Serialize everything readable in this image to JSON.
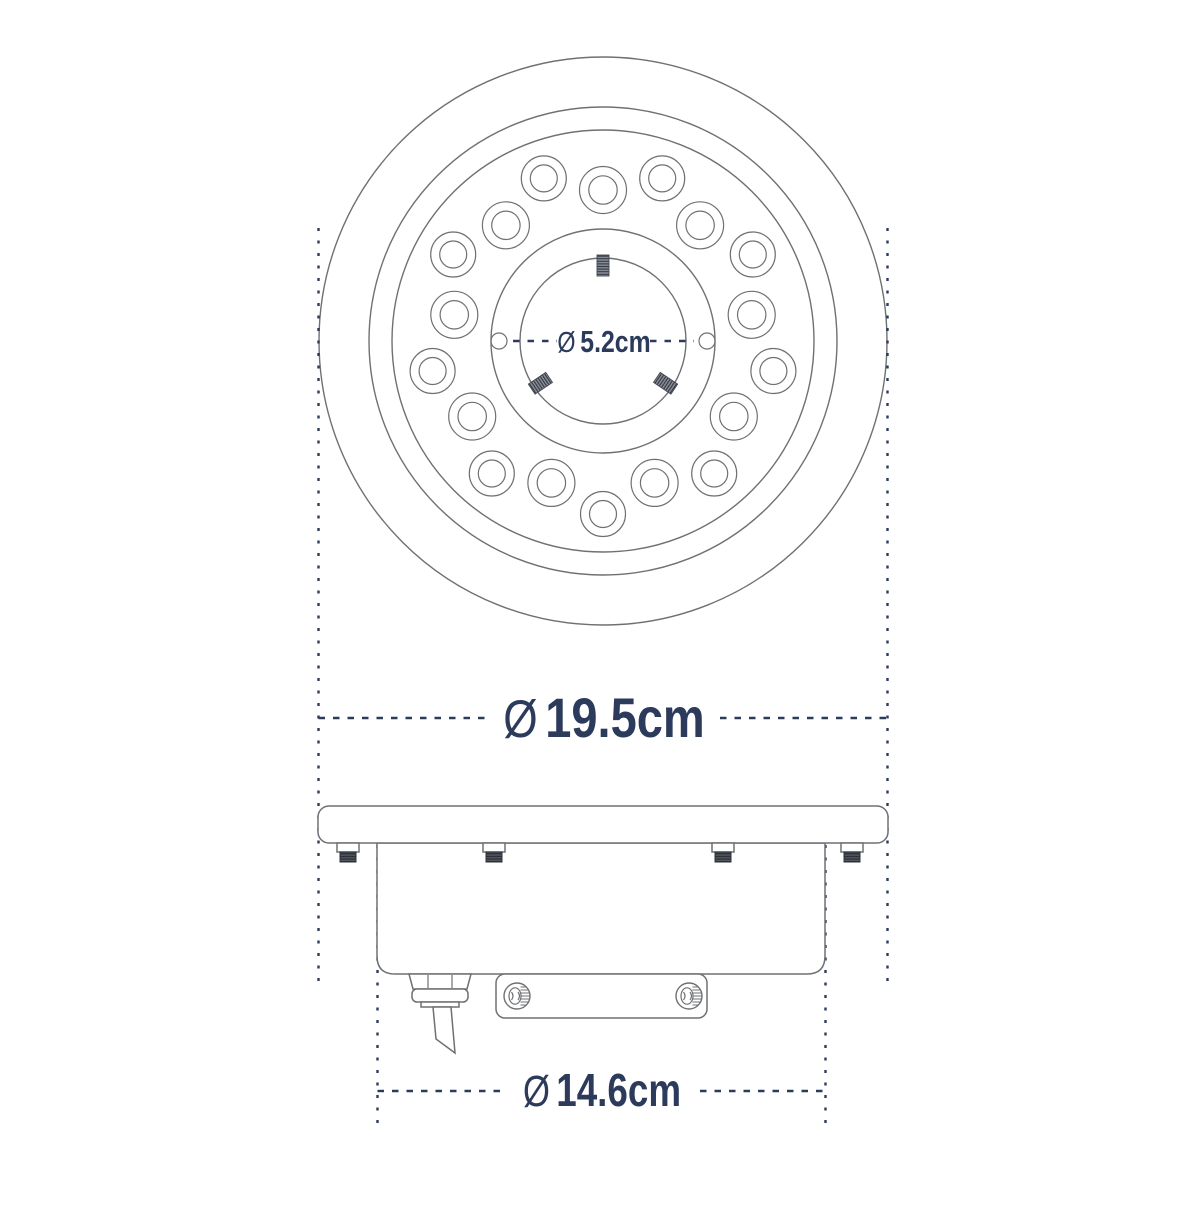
{
  "drawing": {
    "type": "technical-dimension-drawing",
    "product": "round LED fountain/pool light, top view and side view",
    "led_count": 18,
    "dimensions": {
      "hub_diameter": {
        "symbol": "Ø",
        "value": "5.2cm"
      },
      "outer_diameter": {
        "symbol": "Ø",
        "value": "19.5cm"
      },
      "body_diameter": {
        "symbol": "Ø",
        "value": "14.6cm"
      }
    },
    "colors": {
      "dimension_text": "#2c3a5c",
      "drawing_line": "#6e7073"
    }
  }
}
